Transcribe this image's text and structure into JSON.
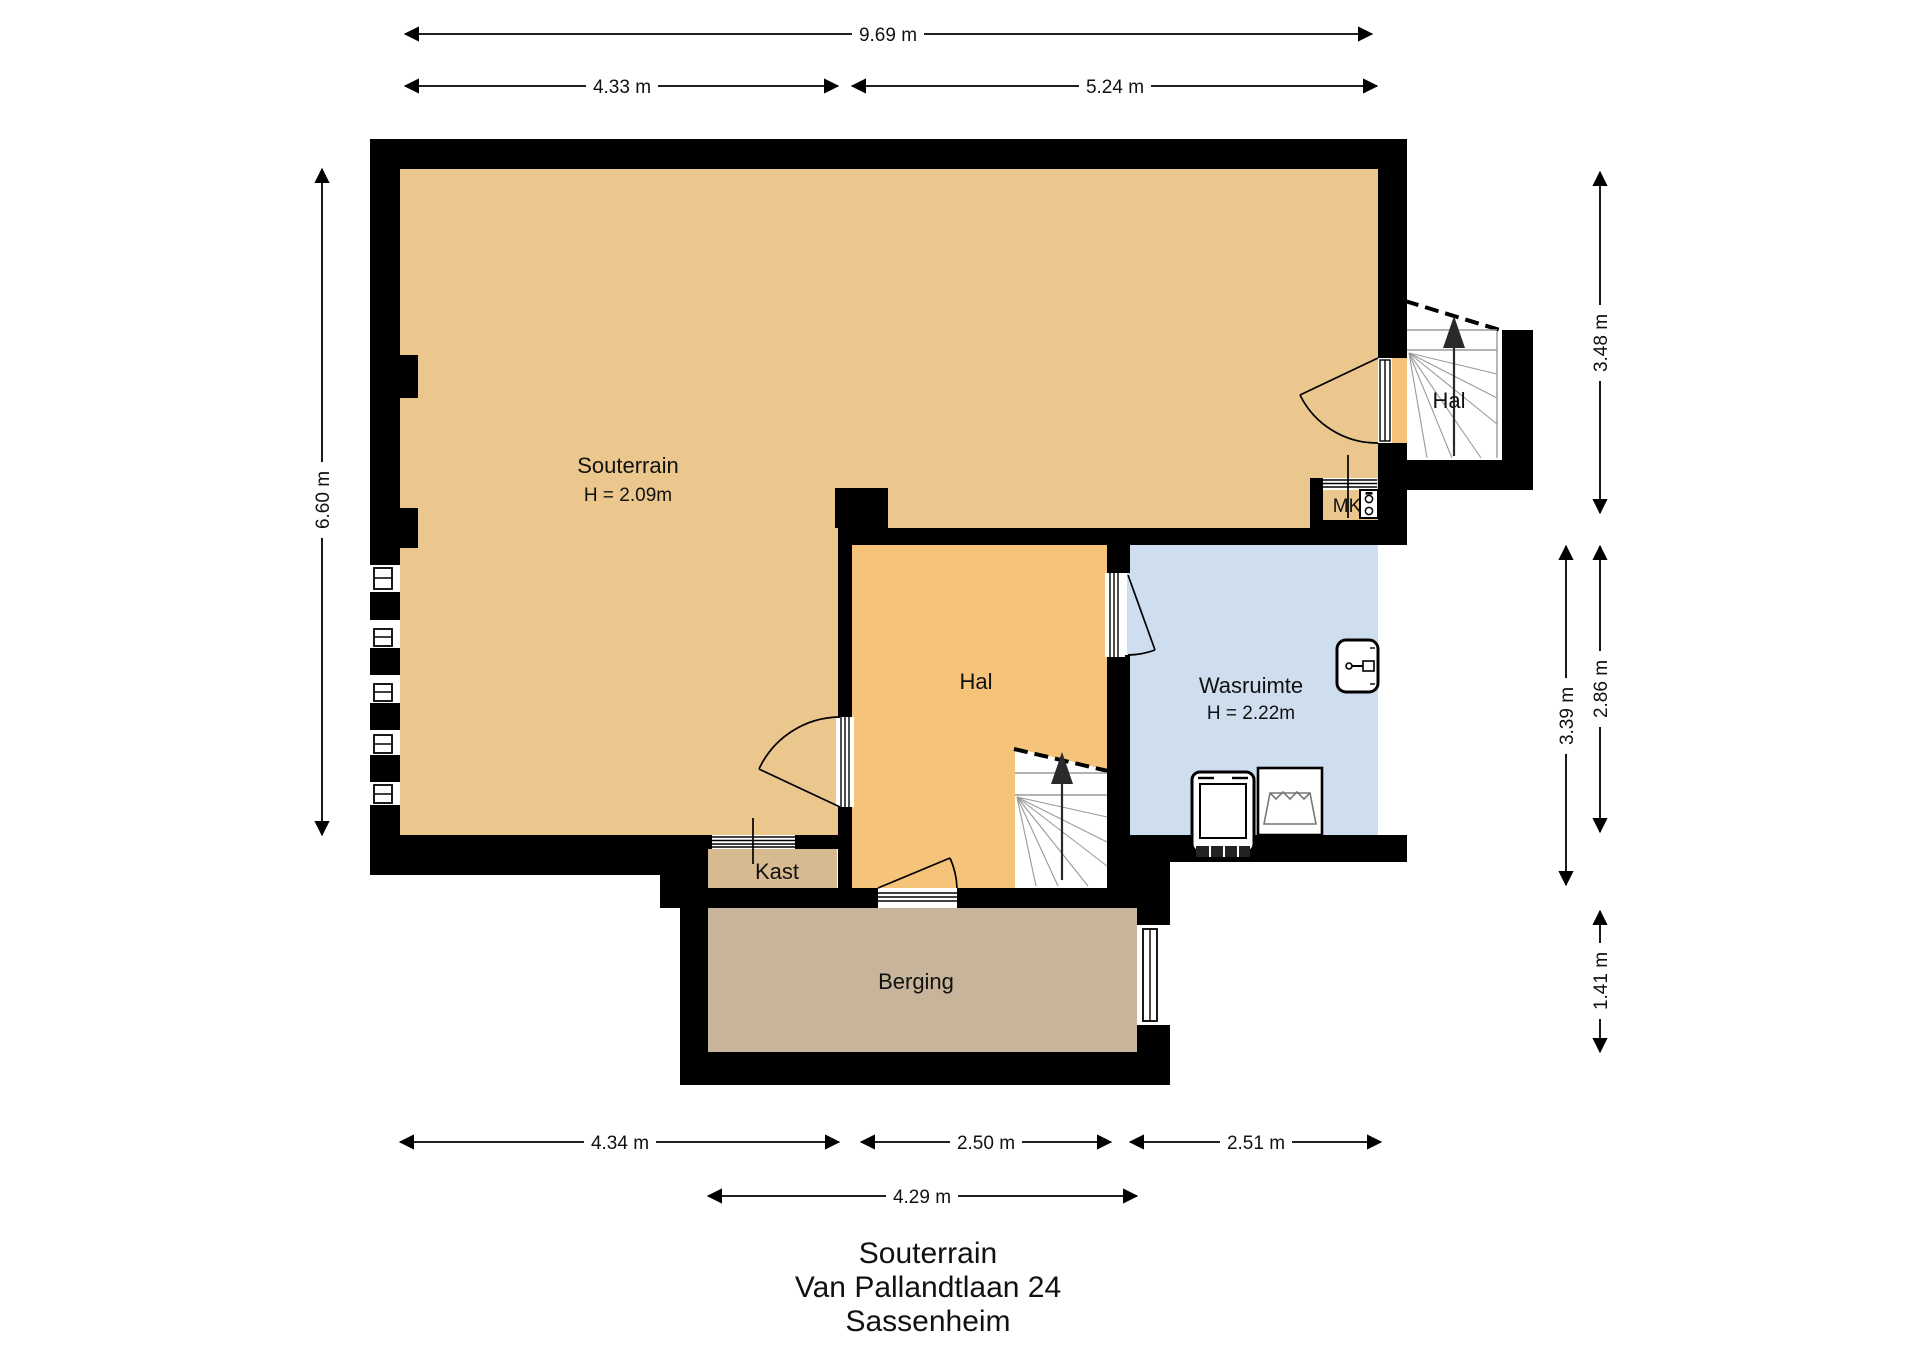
{
  "plan": {
    "rooms": {
      "souterrain": {
        "label": "Souterrain",
        "height_label": "H = 2.09m"
      },
      "stair_hal": {
        "label": "Hal"
      },
      "meter_closet": {
        "label": "MK"
      },
      "hal": {
        "label": "Hal"
      },
      "wasruimte": {
        "label": "Wasruimte",
        "height_label": "H = 2.22m"
      },
      "kast": {
        "label": "Kast"
      },
      "berging": {
        "label": "Berging"
      }
    },
    "dimensions": {
      "top_total": "9.69 m",
      "top_left": "4.33 m",
      "top_right": "5.24 m",
      "left_height": "6.60 m",
      "right_upper": "3.48 m",
      "right_middle_outer": "2.86 m",
      "right_middle_inner": "3.39 m",
      "right_lower": "1.41 m",
      "bottom_left": "4.34 m",
      "bottom_middle": "2.50 m",
      "bottom_right": "2.51 m",
      "bottom_berging": "4.29 m"
    },
    "colors": {
      "wall": "#000000",
      "souterrain": "#ebc78e",
      "hal": "#f6c37b",
      "wasruimte": "#cfdeee",
      "berging": "#c8b49a",
      "kast": "#d8ba90",
      "mk": "#ebc78e",
      "wing_opening": "#f6c37b"
    }
  },
  "footer": {
    "line1": "Souterrain",
    "line2": "Van Pallandtlaan 24",
    "line3": "Sassenheim"
  }
}
